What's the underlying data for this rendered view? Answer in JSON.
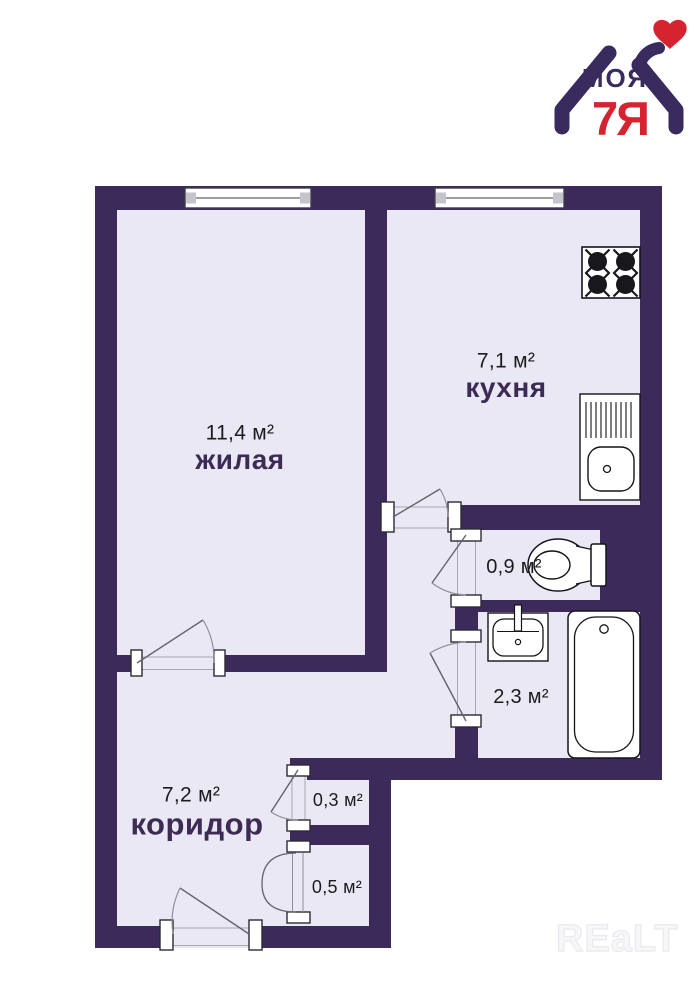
{
  "logo": {
    "top_word": "МОЯ",
    "bottom_word": "7Я"
  },
  "watermark": "REaLT",
  "rooms": [
    {
      "key": "living",
      "name": "жилая",
      "area": "11,4 м²"
    },
    {
      "key": "kitchen",
      "name": "кухня",
      "area": "7,1 м²"
    },
    {
      "key": "wc",
      "name": "",
      "area": "0,9 м²"
    },
    {
      "key": "bathroom",
      "name": "",
      "area": "2,3 м²"
    },
    {
      "key": "corridor",
      "name": "коридор",
      "area": "7,2 м²"
    },
    {
      "key": "closet-small",
      "name": "",
      "area": "0,3 м²"
    },
    {
      "key": "closet-big",
      "name": "",
      "area": "0,5 м²"
    }
  ],
  "fixtures": [
    "stove",
    "kitchen-sink",
    "toilet",
    "washbasin",
    "bathtub"
  ],
  "colors": {
    "wall": "#3c2b5a",
    "floor": "#e9e8f4",
    "room_name_text": "#3d2b56",
    "area_text": "#1c1c1e",
    "logo_purple": "#3a2b5e",
    "logo_red": "#d52330"
  }
}
